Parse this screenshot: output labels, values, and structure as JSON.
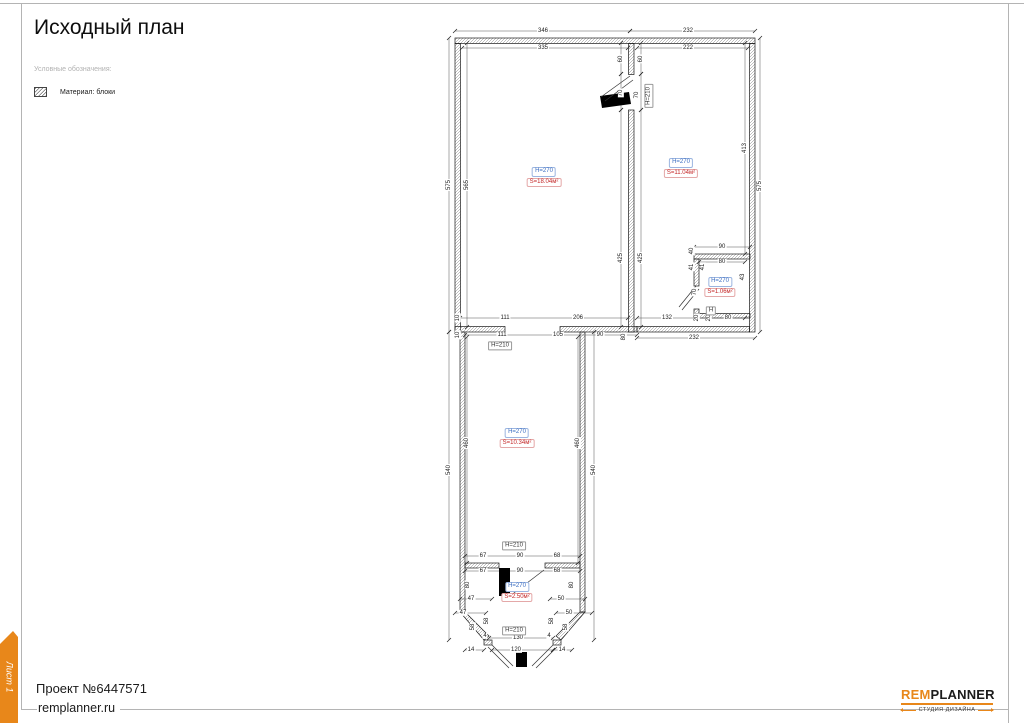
{
  "page": {
    "title": "Исходный план",
    "legend_title": "Условные обозначения:",
    "legend_item": "Материал: блоки",
    "sheet_tab": "Лист 1",
    "project": "Проект №6447571",
    "site": "remplanner.ru",
    "logo": {
      "part1": "REM",
      "part2": "PLANNER",
      "tagline": "СТУДИЯ ДИЗАЙНА"
    },
    "accent_orange": "#e8871a"
  },
  "plan": {
    "rooms": [
      {
        "h": "H=270",
        "s": "S=18.04м²",
        "x": 544,
        "y": 177
      },
      {
        "h": "H=270",
        "s": "S=11.04м²",
        "x": 681,
        "y": 168
      },
      {
        "h": "H=270",
        "s": "S=1.06м²",
        "x": 720,
        "y": 287
      },
      {
        "h": "H=270",
        "s": "S=10.34м²",
        "x": 517,
        "y": 438
      },
      {
        "h": "H=270",
        "s": "S=2.50м²",
        "x": 517,
        "y": 592
      }
    ],
    "height_boxes": [
      {
        "t": "H=210",
        "x": 649,
        "y": 96,
        "r": 1
      },
      {
        "t": "H=210",
        "x": 500,
        "y": 346
      },
      {
        "t": "H=210",
        "x": 514,
        "y": 546
      },
      {
        "t": "H=210",
        "x": 514,
        "y": 631
      },
      {
        "t": "H",
        "x": 711,
        "y": 311
      }
    ],
    "dims": [
      {
        "t": "346",
        "x": 543,
        "y": 31
      },
      {
        "t": "232",
        "x": 688,
        "y": 31
      },
      {
        "t": "335",
        "x": 543,
        "y": 48
      },
      {
        "t": "222",
        "x": 688,
        "y": 48
      },
      {
        "t": "575",
        "x": 449,
        "y": 185,
        "r": 1
      },
      {
        "t": "565",
        "x": 467,
        "y": 185,
        "r": 1
      },
      {
        "t": "575",
        "x": 760,
        "y": 186,
        "r": 1
      },
      {
        "t": "413",
        "x": 745,
        "y": 148,
        "r": 1
      },
      {
        "t": "60",
        "x": 621,
        "y": 59,
        "r": 1
      },
      {
        "t": "60",
        "x": 641,
        "y": 59,
        "r": 1
      },
      {
        "t": "70",
        "x": 621,
        "y": 93,
        "r": 1
      },
      {
        "t": "70",
        "x": 637,
        "y": 95,
        "r": 1
      },
      {
        "t": "425",
        "x": 621,
        "y": 258,
        "r": 1
      },
      {
        "t": "425",
        "x": 641,
        "y": 258,
        "r": 1
      },
      {
        "t": "90",
        "x": 722,
        "y": 247
      },
      {
        "t": "80",
        "x": 722,
        "y": 262
      },
      {
        "t": "40",
        "x": 692,
        "y": 251,
        "r": 1
      },
      {
        "t": "41",
        "x": 692,
        "y": 267,
        "r": 1
      },
      {
        "t": "41",
        "x": 703,
        "y": 267,
        "r": 1
      },
      {
        "t": "70",
        "x": 695,
        "y": 292,
        "r": 1
      },
      {
        "t": "43",
        "x": 743,
        "y": 277,
        "r": 1
      },
      {
        "t": "132",
        "x": 667,
        "y": 318
      },
      {
        "t": "20",
        "x": 697,
        "y": 318,
        "r": 1
      },
      {
        "t": "20",
        "x": 709,
        "y": 318,
        "r": 1
      },
      {
        "t": "80",
        "x": 728,
        "y": 318
      },
      {
        "t": "232",
        "x": 694,
        "y": 338
      },
      {
        "t": "80",
        "x": 624,
        "y": 337,
        "r": 1
      },
      {
        "t": "10",
        "x": 458,
        "y": 318,
        "r": 1
      },
      {
        "t": "111",
        "x": 505,
        "y": 318
      },
      {
        "t": "206",
        "x": 578,
        "y": 318
      },
      {
        "t": "10",
        "x": 458,
        "y": 335,
        "r": 1
      },
      {
        "t": "111",
        "x": 502,
        "y": 335
      },
      {
        "t": "105",
        "x": 558,
        "y": 335
      },
      {
        "t": "90",
        "x": 600,
        "y": 335
      },
      {
        "t": "460",
        "x": 467,
        "y": 443,
        "r": 1
      },
      {
        "t": "540",
        "x": 449,
        "y": 470,
        "r": 1
      },
      {
        "t": "460",
        "x": 578,
        "y": 443,
        "r": 1
      },
      {
        "t": "540",
        "x": 594,
        "y": 470,
        "r": 1
      },
      {
        "t": "67",
        "x": 483,
        "y": 556
      },
      {
        "t": "90",
        "x": 520,
        "y": 556
      },
      {
        "t": "68",
        "x": 557,
        "y": 556
      },
      {
        "t": "67",
        "x": 483,
        "y": 571
      },
      {
        "t": "90",
        "x": 520,
        "y": 571
      },
      {
        "t": "68",
        "x": 557,
        "y": 571
      },
      {
        "t": "80",
        "x": 468,
        "y": 585,
        "r": 1
      },
      {
        "t": "80",
        "x": 572,
        "y": 585,
        "r": 1
      },
      {
        "t": "47",
        "x": 471,
        "y": 599
      },
      {
        "t": "50",
        "x": 561,
        "y": 599
      },
      {
        "t": "47",
        "x": 463,
        "y": 613
      },
      {
        "t": "50",
        "x": 569,
        "y": 613
      },
      {
        "t": "58",
        "x": 473,
        "y": 627,
        "r": 1
      },
      {
        "t": "58",
        "x": 487,
        "y": 621,
        "r": 1
      },
      {
        "t": "58",
        "x": 552,
        "y": 621,
        "r": 1
      },
      {
        "t": "58",
        "x": 566,
        "y": 627,
        "r": 1
      },
      {
        "t": "4",
        "x": 485,
        "y": 636
      },
      {
        "t": "4",
        "x": 549,
        "y": 636
      },
      {
        "t": "130",
        "x": 518,
        "y": 638
      },
      {
        "t": "120",
        "x": 516,
        "y": 650
      },
      {
        "t": "14",
        "x": 471,
        "y": 650
      },
      {
        "t": "14",
        "x": 562,
        "y": 650
      }
    ]
  }
}
